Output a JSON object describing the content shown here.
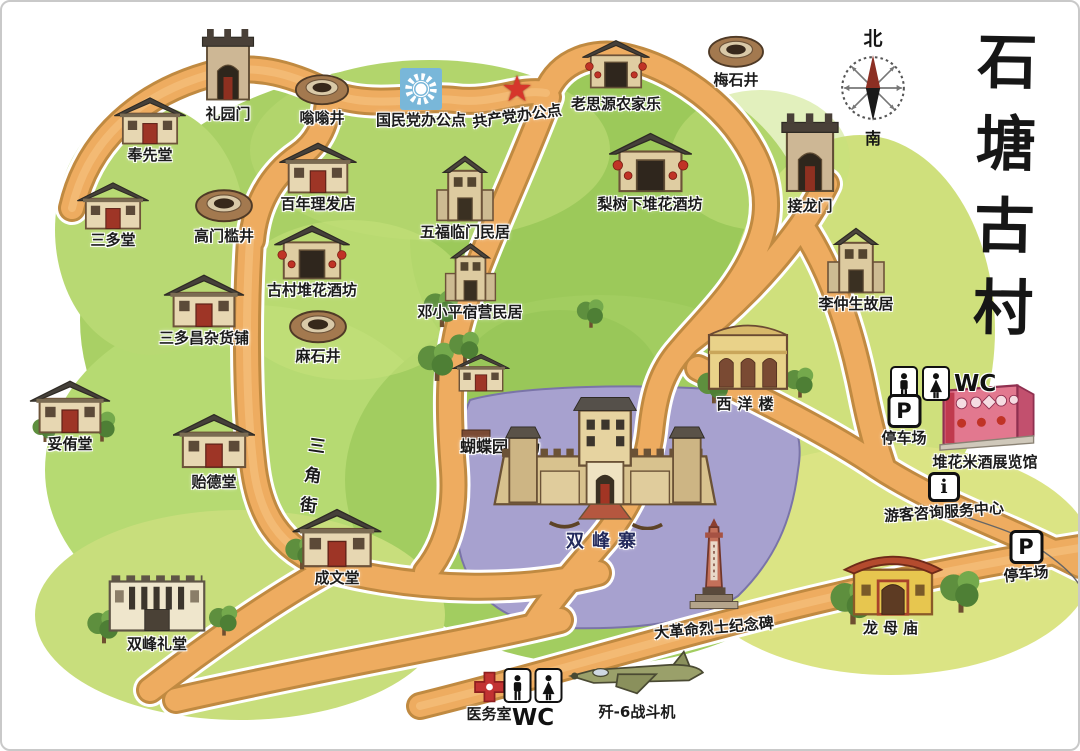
{
  "title": {
    "text": "石塘古村"
  },
  "compass": {
    "north": "北",
    "south": "南"
  },
  "street": {
    "name": "三角街"
  },
  "icons": {
    "parking_letter": "P",
    "info_letter": "i",
    "star_glyph": "★"
  },
  "colors": {
    "road": "#EEAC60",
    "green": "#A9D065",
    "moat": "#A7A1CF",
    "star_red": "#D6362B",
    "kmt_blue": "#79B7D9"
  },
  "landmarks": [
    {
      "label": "奉先堂"
    },
    {
      "label": "礼园门"
    },
    {
      "label": "嗡嗡井"
    },
    {
      "label": "国民党办公点"
    },
    {
      "label": "共产党办公点"
    },
    {
      "label": "老思源农家乐"
    },
    {
      "label": "梅石井"
    },
    {
      "label": "接龙门"
    },
    {
      "label": "三多堂"
    },
    {
      "label": "高门槛井"
    },
    {
      "label": "百年理发店"
    },
    {
      "label": "古村堆花酒坊"
    },
    {
      "label": "五福临门民居"
    },
    {
      "label": "梨树下堆花酒坊"
    },
    {
      "label": "李仲生故居"
    },
    {
      "label": "三多昌杂货铺"
    },
    {
      "label": "麻石井"
    },
    {
      "label": "邓小平宿营民居"
    },
    {
      "label": "妥侑堂"
    },
    {
      "label": "贻德堂"
    },
    {
      "label": "蝴蝶园广场"
    },
    {
      "label": "西洋楼"
    },
    {
      "label": "双峰寨"
    },
    {
      "label": "成文堂"
    },
    {
      "label": "双峰礼堂"
    },
    {
      "label": "大革命烈士纪念碑"
    },
    {
      "label": "龙母庙"
    },
    {
      "label": "堆花米酒展览馆"
    },
    {
      "label": "游客咨询服务中心"
    },
    {
      "label": "医务室"
    },
    {
      "label": "歼-6战斗机"
    },
    {
      "label": "WC"
    },
    {
      "label": "停车场"
    },
    {
      "label": "停车场"
    },
    {
      "label": "WC"
    }
  ]
}
